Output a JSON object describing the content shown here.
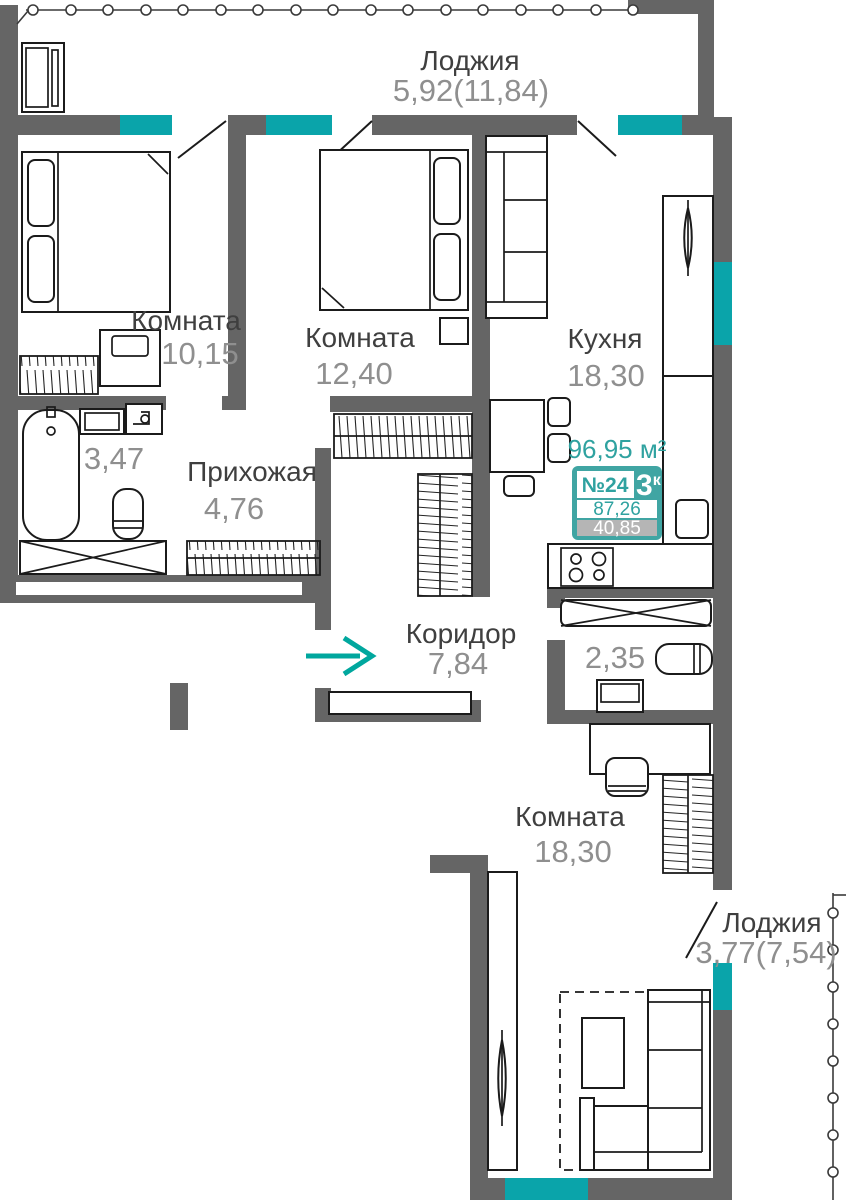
{
  "meta": {
    "canvas_width": 846,
    "canvas_height": 1200,
    "background": "#ffffff"
  },
  "colors": {
    "wall": "#656565",
    "window": "#0aa4aa",
    "arrow": "#00a79e",
    "badge_teal": "#40a5a3",
    "badge_gray": "#b5b5b5",
    "badge_text": "#2fa2a0",
    "name_text": "#3f3f3f",
    "area_text": "#8f8f8f",
    "stroke": "#1b1b1b"
  },
  "badge": {
    "total_area": "96,95 м²",
    "apartment_number": "№24",
    "rooms_count_value": "3",
    "rooms_count_suffix": "к",
    "area_living": "87,26",
    "area_extra": "40,85"
  },
  "rooms": {
    "loggia_top": {
      "name": "Лоджия",
      "area": "5,92(11,84)"
    },
    "bedroom_small": {
      "name": "Комната",
      "area": "10,15"
    },
    "bedroom_mid": {
      "name": "Комната",
      "area": "12,40"
    },
    "kitchen": {
      "name": "Кухня",
      "area": "18,30"
    },
    "bathroom": {
      "area": "3,47"
    },
    "hallway": {
      "name": "Прихожая",
      "area": "4,76"
    },
    "corridor": {
      "name": "Коридор",
      "area": "7,84"
    },
    "storage": {
      "area": "2,35"
    },
    "living_room": {
      "name": "Комната",
      "area": "18,30"
    },
    "loggia_bottom": {
      "name": "Лоджия",
      "area": "3,77(7,54)"
    }
  }
}
